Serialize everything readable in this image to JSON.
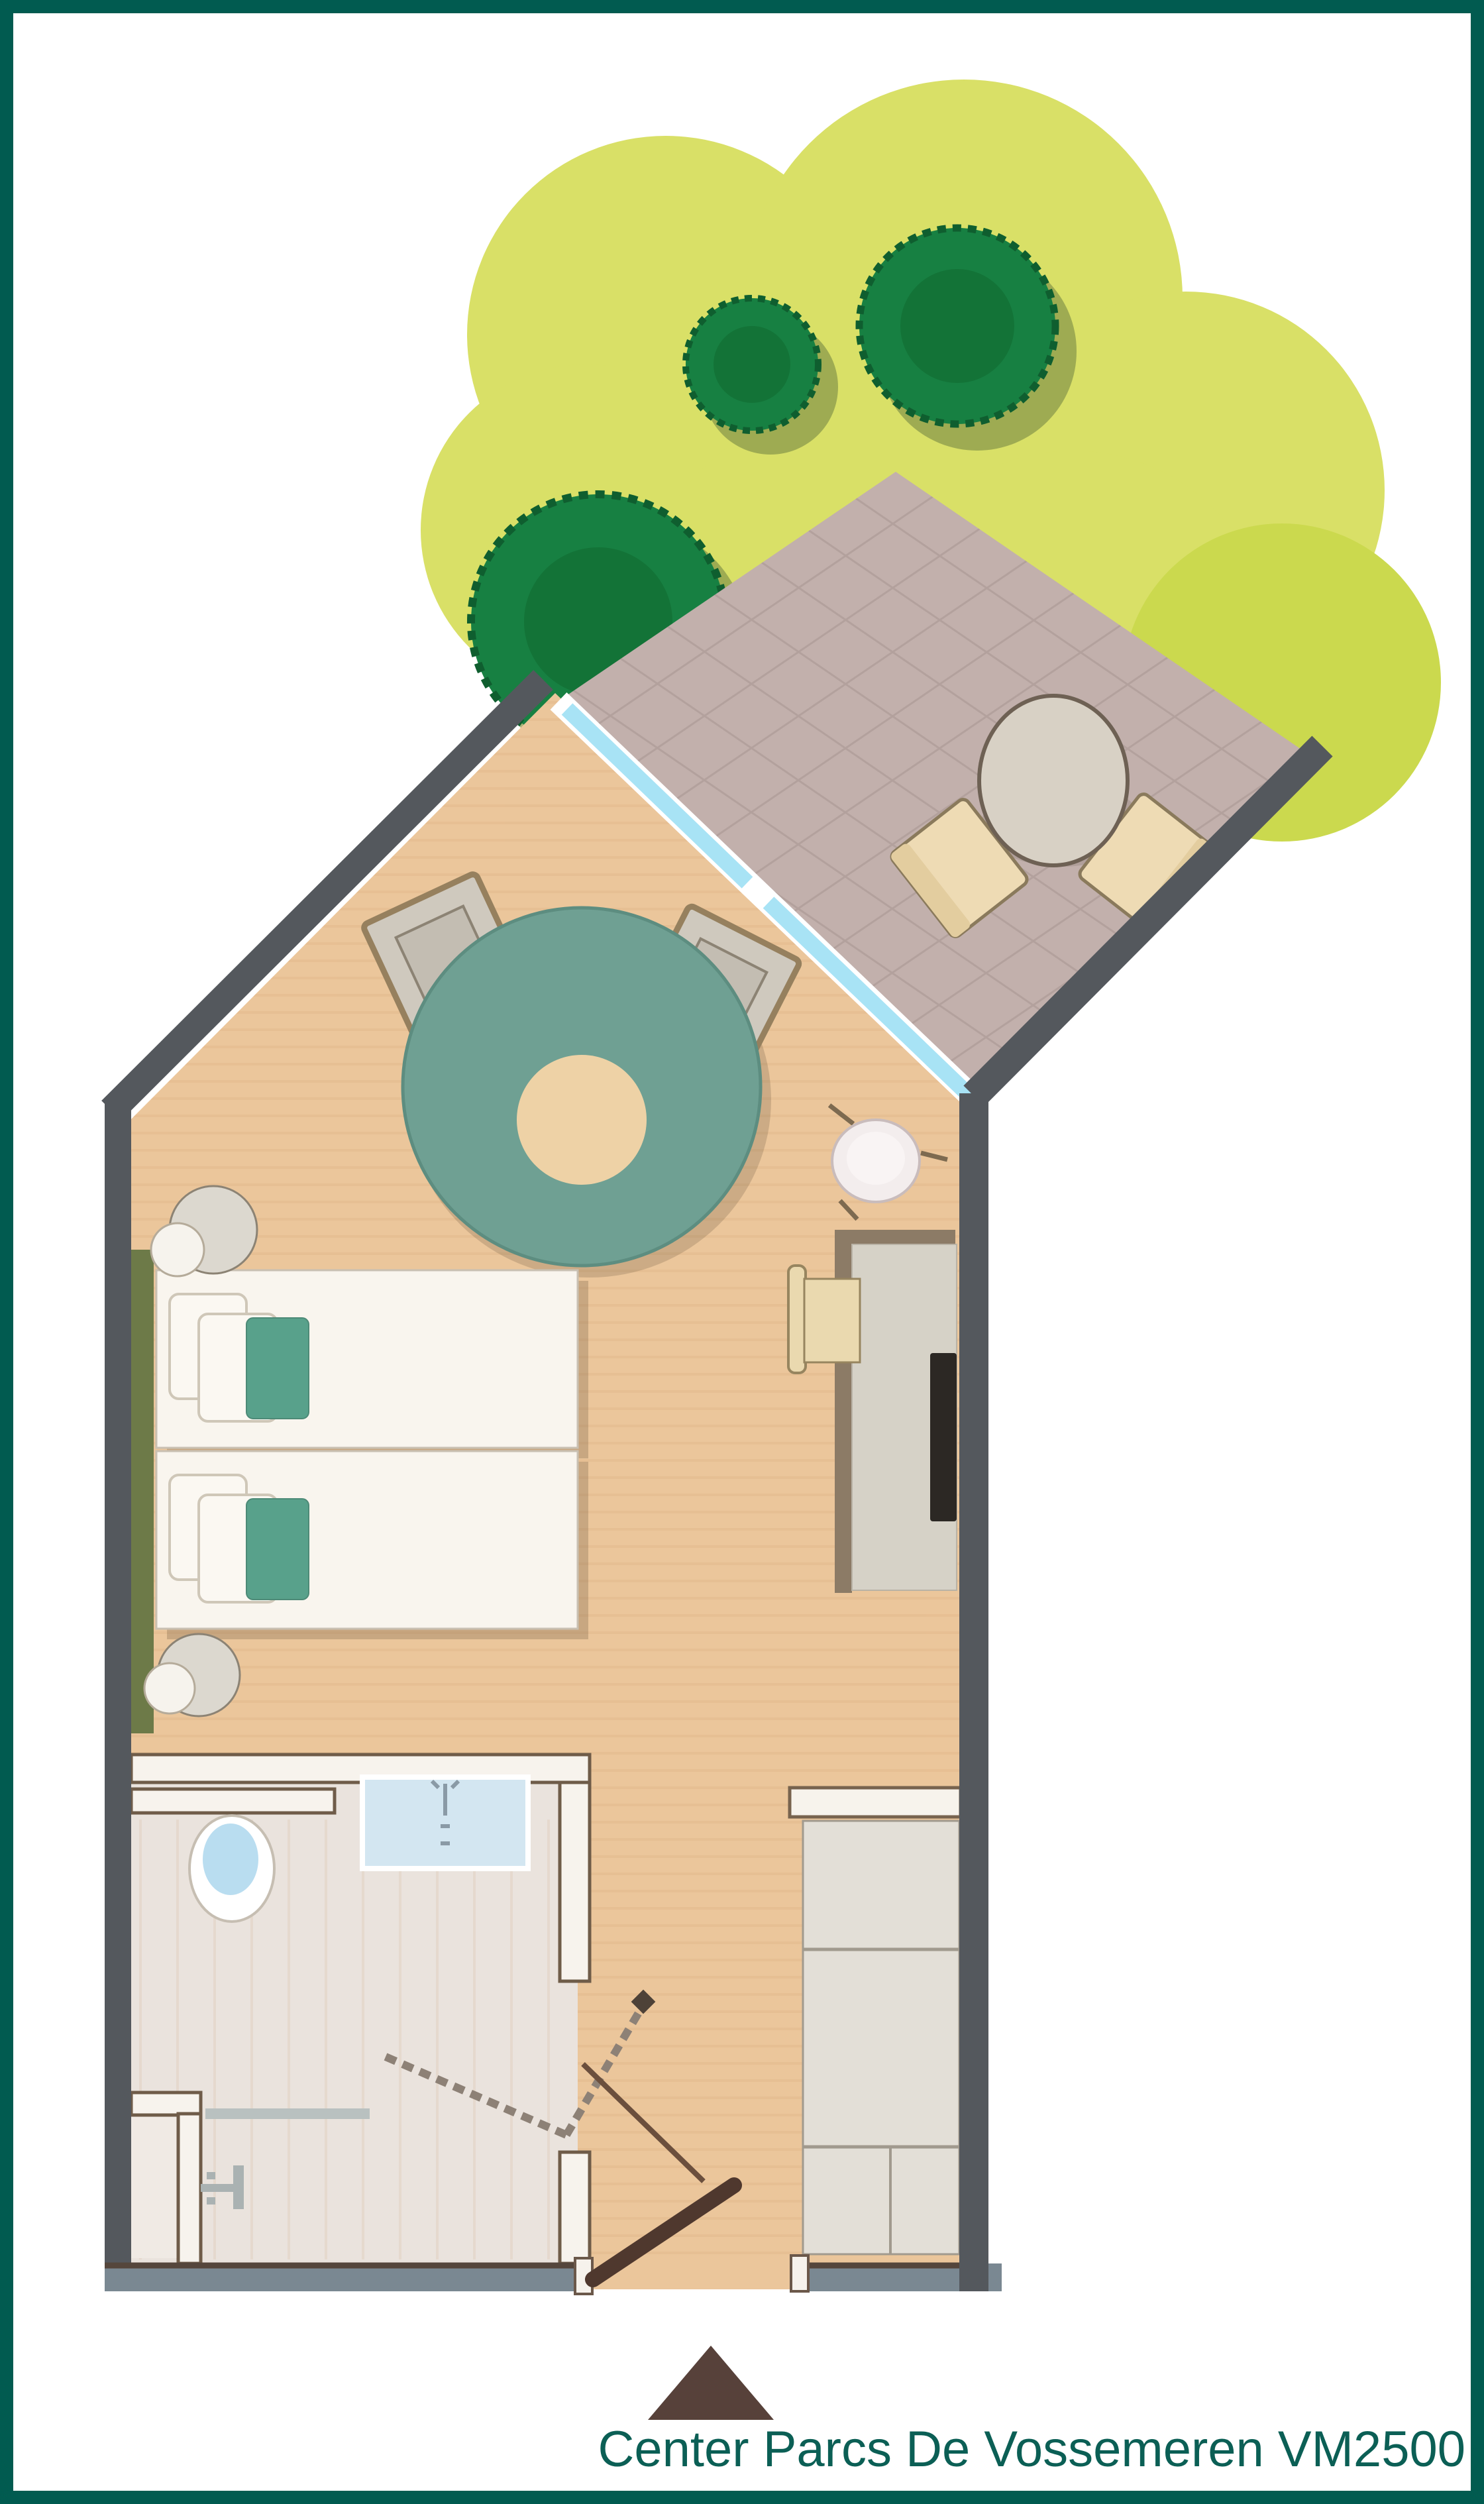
{
  "plan": {
    "title": "Center Parcs De Vossemeren VM2500",
    "title_font_px": 76,
    "unit_code": "VM2500",
    "resort": "Center Parcs De Vossemeren",
    "icons": [
      "tree-icon",
      "terrace-table-icon",
      "terrace-chair-icon",
      "sliding-door-icon",
      "lounge-chair-icon",
      "round-rug-icon",
      "twin-bed-icon",
      "pillow-icon",
      "bedside-lamp-icon",
      "washbasin-icon",
      "desk-icon",
      "desk-chair-icon",
      "tv-icon",
      "wardrobe-icon",
      "toilet-icon",
      "sink-icon",
      "towel-bar-icon",
      "shower-icon",
      "door-swing-icon",
      "entrance-door-icon",
      "entrance-marker-triangle-icon"
    ],
    "colors": {
      "frame": "#015b50",
      "page_bg": "#ffffff",
      "grass": "#d9e067",
      "grass_lime": "#cbd94e",
      "tree": "#178042",
      "tree_core": "#11672f",
      "tree_shadow": "#8a9a4b",
      "tree_ring": "#0f5e2f",
      "terrace": "#c2b0ac",
      "terrace_grid": "#9c8a86",
      "wall": "#54585d",
      "wall_bottom": "#7a8892",
      "wall_bottom_edge": "#55463c",
      "floor": "#ebc69b",
      "floor_stripe": "#c08a52",
      "sliding_door": "#a8e3f5",
      "olive_panel": "#6d7a48",
      "bed": "#f9f5ee",
      "bed_edge": "#c9c0b2",
      "pillow": "#fbf8f2",
      "pillow_edge": "#cfc7b8",
      "runner": "#58a18b",
      "runner_edge": "#4d8a77",
      "lamp": "#dcd8cf",
      "lamp_edge": "#8c8374",
      "lamp_small": "#f6f3ed",
      "lamp_small_edge": "#b5ab9a",
      "rug": "#6fa093",
      "rug_edge": "#5d8d80",
      "rug_center": "#eed2a6",
      "chair_frame": "#96805e",
      "chair_seat": "#cfc9be",
      "chair_seat_inner": "#c3bdb2",
      "terrace_table": "#d8d1c5",
      "terrace_table_edge": "#6e6154",
      "terrace_chair": "#eedbb4",
      "terrace_chair_edge": "#8a7a5c",
      "terrace_chair_back": "#e3cd9f",
      "basin": "#f3eded",
      "basin_edge": "#c9bcbc",
      "basin_inner": "#f9f4f4",
      "basin_tick": "#7d6a50",
      "desk": "#d6d2c7",
      "desk_edge": "#b9b3a6",
      "desk_shadow": "#8c7b66",
      "tv": "#2c2824",
      "desk_chair": "#ead9af",
      "desk_chair_edge": "#97855f",
      "wardrobe": "#e3dfd7",
      "wardrobe_line": "#a19a8e",
      "shelf": "#f7f3ec",
      "shelf_edge": "#77634e",
      "bath_floor": "#eae3dd",
      "shower_floor": "#f0eae4",
      "inner_wall": "#f7f3ed",
      "inner_wall_edge": "#6f5c49",
      "toilet": "#ffffff",
      "toilet_edge": "#c6beb2",
      "toilet_bowl": "#b9ddf0",
      "sink": "#d3e6f1",
      "sink_edge": "#ffffff",
      "faucet": "#8a9aa6",
      "towel_bar": "#b9c1c0",
      "shower_icon": "#aab2b2",
      "hatch": "#8d8176",
      "handle": "#4e4238",
      "bath_door": "#6b4f3d",
      "entrance_door": "#4f382e",
      "jamb": "#f6f2ec",
      "jamb_edge": "#6b584a",
      "triangle": "#57413a",
      "title": "#0b5f55"
    }
  }
}
